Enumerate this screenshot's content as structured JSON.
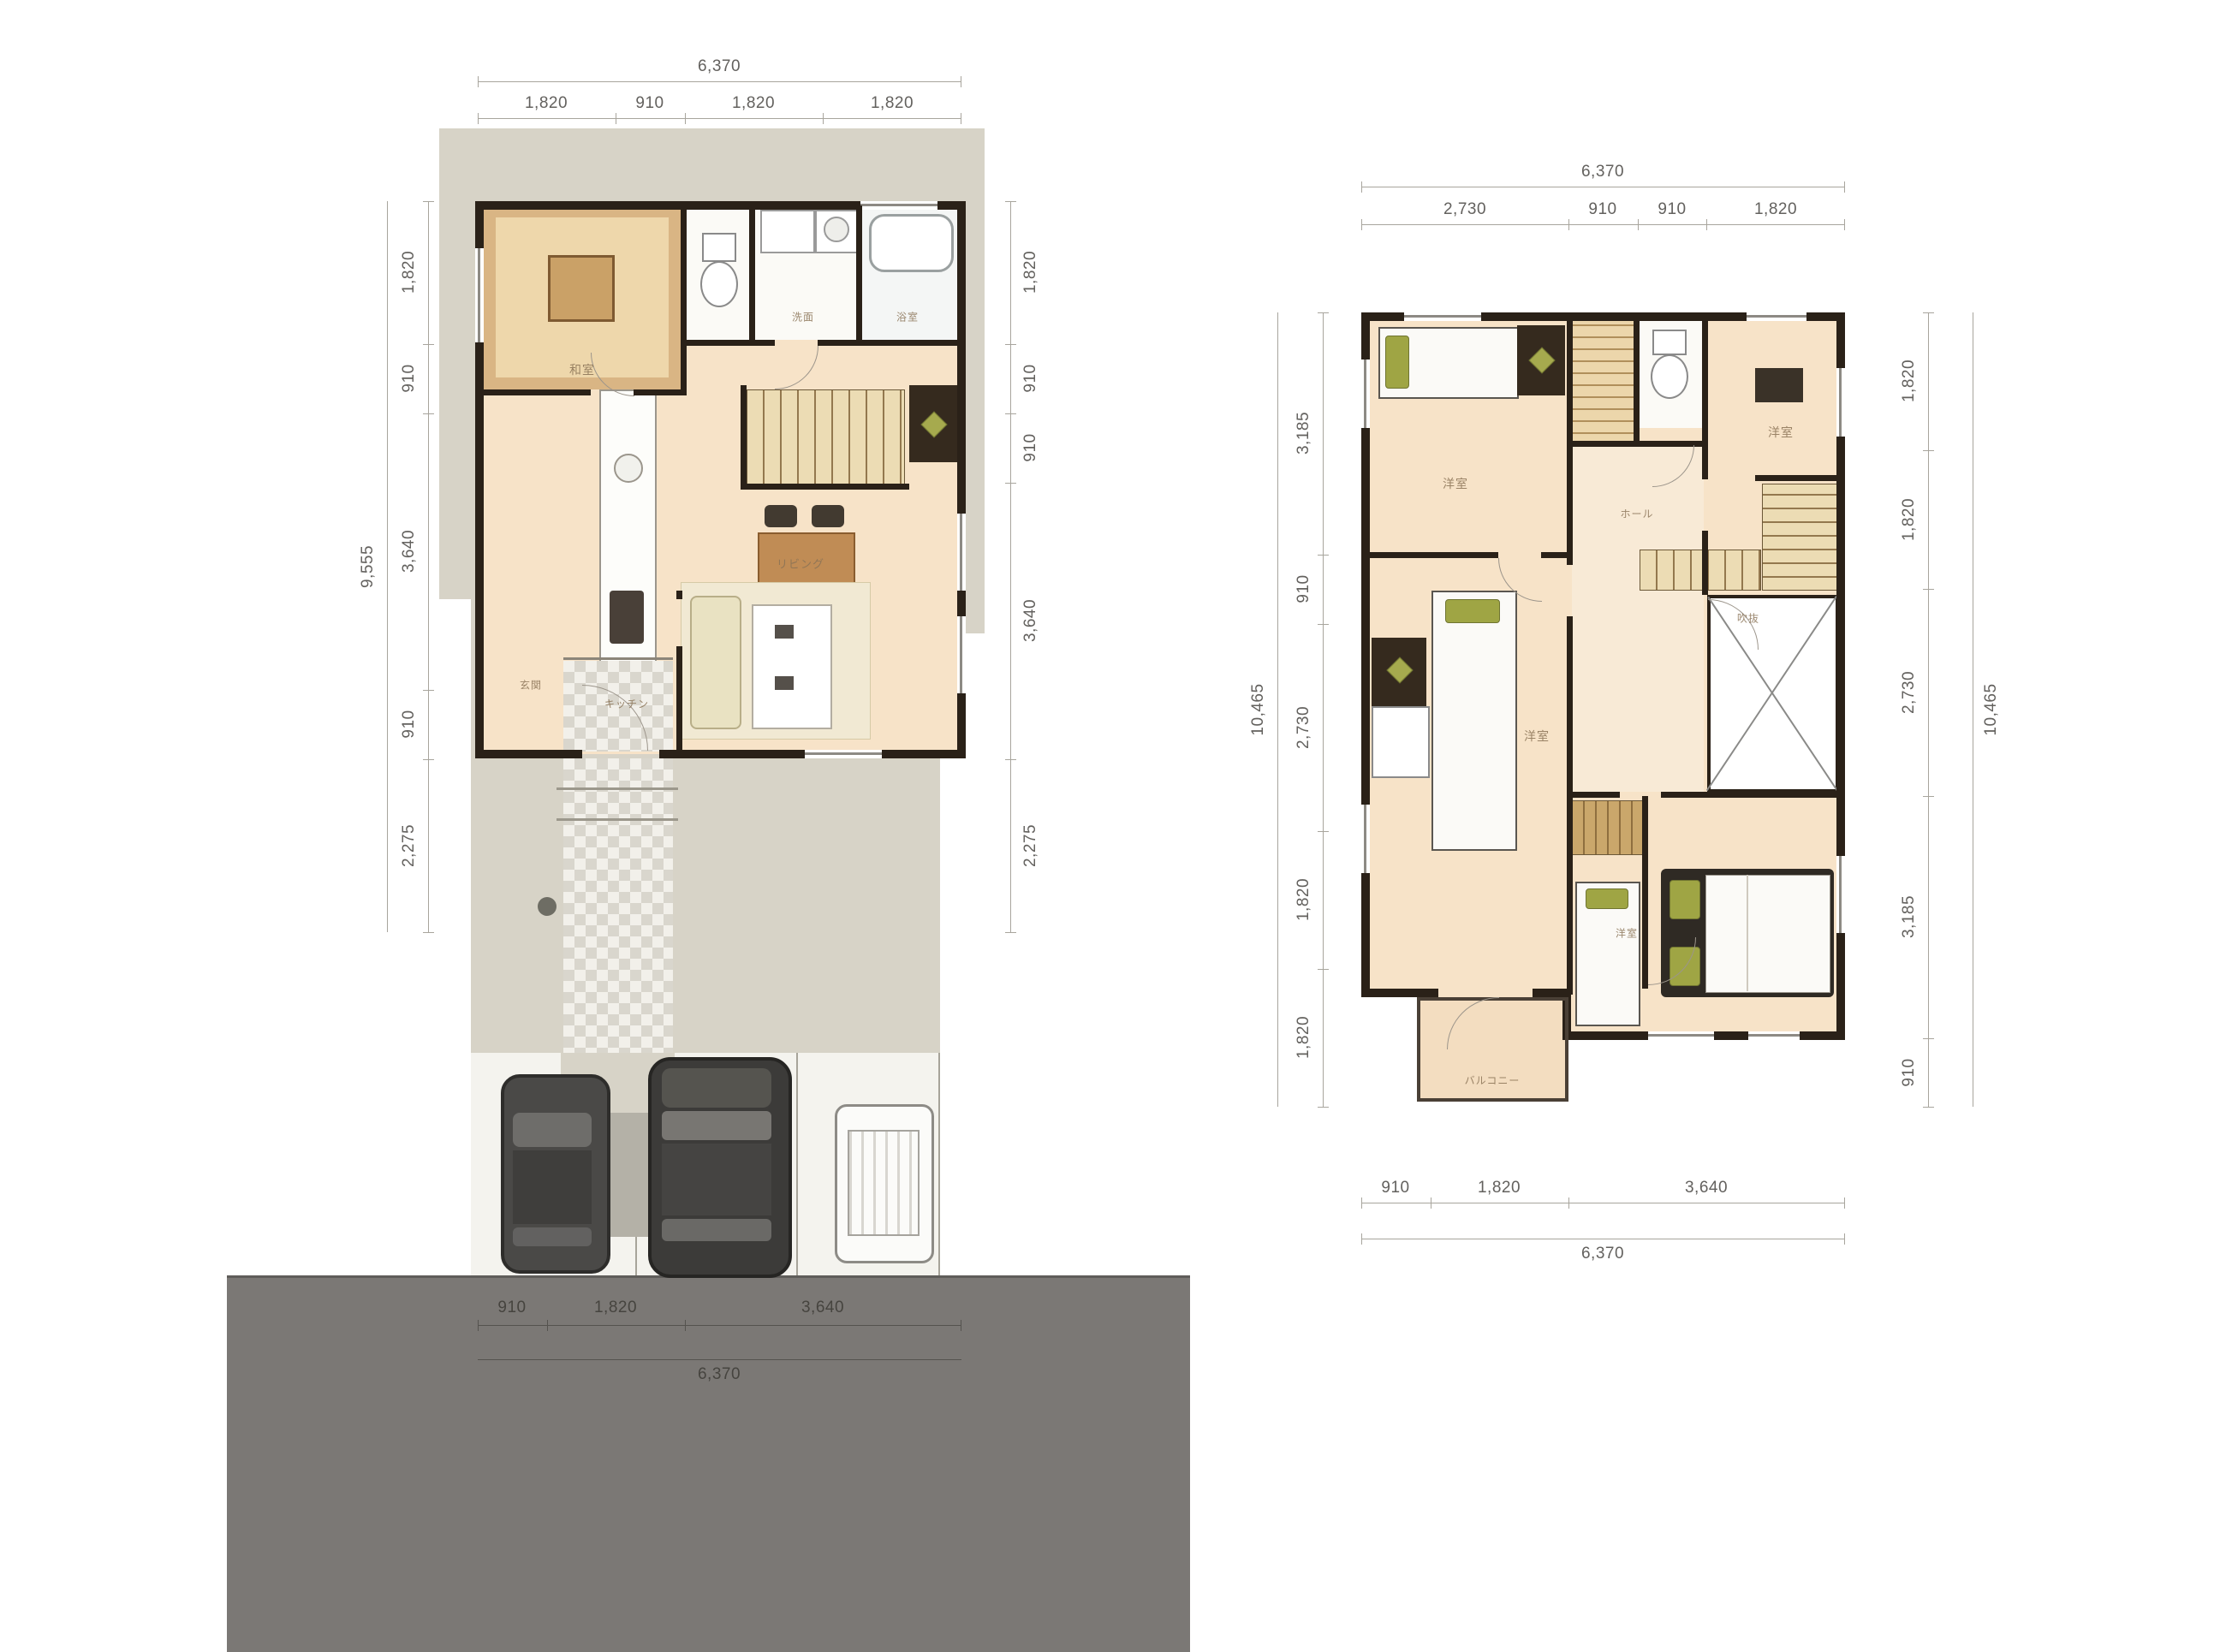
{
  "sheet": {
    "title": "house-floor-plans"
  },
  "colors": {
    "wall": "#2a2118",
    "room_floor": "#f7e3c8",
    "tatami_border": "#c79a62",
    "site_gray": "#d7d3c7",
    "road_gray": "#7b7875",
    "accent_green": "#9fa544",
    "dim_text": "#63615e"
  },
  "plan1": {
    "dims": {
      "top": {
        "overall": "6,370",
        "segments": [
          "1,820",
          "910",
          "1,820",
          "1,820"
        ]
      },
      "left": {
        "overall": "9,555",
        "segments": [
          "1,820",
          "910",
          "3,640",
          "910",
          "2,275"
        ]
      },
      "right": {
        "segments": [
          "1,820",
          "910",
          "910",
          "3,640",
          "2,275"
        ]
      },
      "bottom": {
        "overall": "6,370",
        "segments": [
          "910",
          "1,820",
          "3,640"
        ]
      }
    },
    "rooms": {
      "tatami": "和室",
      "washroom": "洗面",
      "bath": "浴室",
      "kitchen": "キッチン",
      "living": "リビング",
      "genkan": "玄関"
    }
  },
  "plan2": {
    "dims": {
      "top": {
        "overall": "6,370",
        "segments": [
          "2,730",
          "910",
          "910",
          "1,820"
        ]
      },
      "left": {
        "overall": "10,465",
        "segments": [
          "3,185",
          "910",
          "2,730",
          "1,820",
          "1,820"
        ]
      },
      "right": {
        "overall": "10,465",
        "segments": [
          "1,820",
          "1,820",
          "2,730",
          "3,185",
          "910"
        ]
      },
      "bottom": {
        "overall": "6,370",
        "segments": [
          "910",
          "1,820",
          "3,640"
        ]
      }
    },
    "rooms": {
      "bedroom1": "洋室",
      "bedroom2": "洋室",
      "bedroom3": "洋室",
      "bedroom4": "洋室",
      "hall": "ホール",
      "void": "吹抜",
      "balcony": "バルコニー"
    }
  }
}
